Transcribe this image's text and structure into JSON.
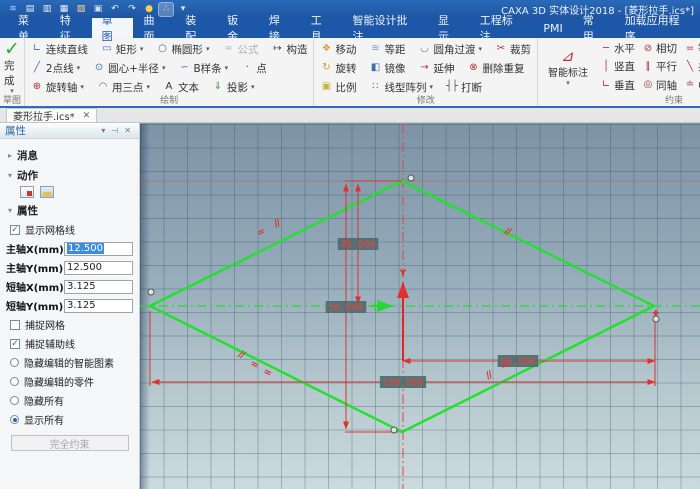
{
  "title_bar": {
    "title": "CAXA 3D 实体设计2018 - [菱形拉手.ics*]"
  },
  "qat": {
    "icons": [
      {
        "name": "app-logo",
        "glyph": "≋",
        "color": "#9fd4ff"
      },
      {
        "name": "new-file",
        "glyph": "▤",
        "color": "#eef3f9"
      },
      {
        "name": "open-file",
        "glyph": "▥",
        "color": "#eef3f9"
      },
      {
        "name": "import-file",
        "glyph": "▦",
        "color": "#eef3f9"
      },
      {
        "name": "open-folder",
        "glyph": "▧",
        "color": "#ffd98a"
      },
      {
        "name": "save",
        "glyph": "▣",
        "color": "#cfe0f2"
      },
      {
        "name": "undo",
        "glyph": "↶",
        "color": "#eef3f9"
      },
      {
        "name": "redo",
        "glyph": "↷",
        "color": "#eef3f9"
      },
      {
        "name": "options",
        "glyph": "●",
        "color": "#ffd24d"
      },
      {
        "name": "snap-settings",
        "glyph": "∴",
        "color": "#ffe28a",
        "active": true
      },
      {
        "name": "more",
        "glyph": "▾",
        "color": "#dbe6f2"
      }
    ]
  },
  "menu": {
    "items": [
      "菜单",
      "特征",
      "草图",
      "曲面",
      "装配",
      "钣金",
      "焊接",
      "工具",
      "智能设计批注",
      "显示",
      "工程标注",
      "PMI",
      "常用",
      "加载应用程序"
    ],
    "active": "草图"
  },
  "ribbon": {
    "sketch": {
      "finish_label": "完成",
      "label": "草图"
    },
    "draw": {
      "label": "绘制",
      "rows": [
        [
          {
            "n": "continuous-line",
            "g": "∟",
            "c": "#3a6fb5",
            "l": "连续直线"
          },
          {
            "n": "rectangle",
            "g": "▭",
            "c": "#3a6fb5",
            "l": "矩形",
            "cr": 1
          },
          {
            "n": "ellipse",
            "g": "○",
            "c": "#3a6fb5",
            "l": "椭圆形",
            "cr": 1
          },
          {
            "n": "formula",
            "g": "≈",
            "c": "#b8b8b8",
            "l": "公式",
            "dis": 1
          },
          {
            "n": "construction",
            "g": "↦",
            "c": "#444444",
            "l": "构造"
          }
        ],
        [
          {
            "n": "two-point-line",
            "g": "╱",
            "c": "#3a6fb5",
            "l": "2点线",
            "cr": 1
          },
          {
            "n": "circle-center-radius",
            "g": "⊙",
            "c": "#3a6fb5",
            "l": "圆心+半径",
            "cr": 1
          },
          {
            "n": "b-spline",
            "g": "∽",
            "c": "#3a6fb5",
            "l": "B样条",
            "cr": 1
          },
          {
            "n": "point",
            "g": "·",
            "c": "#333333",
            "l": "点"
          }
        ],
        [
          {
            "n": "rotation-axis",
            "g": "⊕",
            "c": "#b03030",
            "l": "旋转轴",
            "cr": 1
          },
          {
            "n": "three-point-arc",
            "g": "◠",
            "c": "#3a6fb5",
            "l": "用三点",
            "cr": 1
          },
          {
            "n": "text",
            "g": "A",
            "c": "#333333",
            "l": "文本"
          },
          {
            "n": "projection",
            "g": "⇓",
            "c": "#3a8f5a",
            "l": "投影",
            "cr": 1
          }
        ]
      ]
    },
    "modify": {
      "label": "修改",
      "rows": [
        [
          {
            "n": "move",
            "g": "❖",
            "c": "#e09a3a",
            "l": "移动"
          },
          {
            "n": "offset",
            "g": "≋",
            "c": "#7a9bd4",
            "l": "等距"
          },
          {
            "n": "fillet",
            "g": "◡",
            "c": "#3a6fb5",
            "l": "圆角过渡",
            "cr": 1
          },
          {
            "n": "trim",
            "g": "✂",
            "c": "#b03030",
            "l": "裁剪"
          }
        ],
        [
          {
            "n": "rotate",
            "g": "↻",
            "c": "#c59a3a",
            "l": "旋转"
          },
          {
            "n": "mirror",
            "g": "◧",
            "c": "#3a6fb5",
            "l": "镜像"
          },
          {
            "n": "extend",
            "g": "→",
            "c": "#b03030",
            "l": "延伸"
          },
          {
            "n": "delete-duplicate",
            "g": "⊗",
            "c": "#b03030",
            "l": "删除重复"
          }
        ],
        [
          {
            "n": "scale",
            "g": "▣",
            "c": "#c5b53a",
            "l": "比例"
          },
          {
            "n": "pattern",
            "g": "∷",
            "c": "#3a6fb5",
            "l": "线型阵列",
            "cr": 1
          },
          {
            "n": "break",
            "g": "┤├",
            "c": "#555555",
            "l": "打断"
          }
        ]
      ]
    },
    "constraint": {
      "label": "约束",
      "smart_dim": {
        "n": "smart-dimension",
        "label": "智能标注"
      },
      "rows": [
        [
          {
            "n": "horizontal-constraint",
            "g": "─",
            "c": "#b03030",
            "l": "水平"
          },
          {
            "n": "tangent-constraint",
            "g": "⊘",
            "c": "#b03030",
            "l": "相切"
          },
          {
            "n": "equal-length-constraint",
            "g": "=",
            "c": "#b03030",
            "l": "等长"
          },
          {
            "n": "coincident-constraint",
            "g": "∠",
            "c": "#b03030",
            "l": "重合",
            "act": 1
          },
          {
            "n": "pierce-constraint",
            "g": "▷",
            "c": "#b03030",
            "l": "穿透"
          }
        ],
        [
          {
            "n": "vertical-constraint",
            "g": "│",
            "c": "#b03030",
            "l": "竖直"
          },
          {
            "n": "parallel-constraint",
            "g": "∥",
            "c": "#b03030",
            "l": "平行"
          },
          {
            "n": "collinear-constraint",
            "g": "╲",
            "c": "#b03030",
            "l": "共线"
          },
          {
            "n": "mirror-constraint",
            "g": "◫",
            "c": "#b03030",
            "l": "镜像"
          },
          {
            "n": "edit-dimension",
            "g": "✎",
            "c": "#b03030",
            "l": "编辑尺寸"
          }
        ],
        [
          {
            "n": "perpendicular-constraint",
            "g": "∟",
            "c": "#b03030",
            "l": "垂直"
          },
          {
            "n": "concentric-constraint",
            "g": "◎",
            "c": "#b03030",
            "l": "同轴"
          },
          {
            "n": "midpoint-constraint",
            "g": "≐",
            "c": "#b03030",
            "l": "中点"
          },
          {
            "n": "fixed-constraint",
            "g": "⊥",
            "c": "#b03030",
            "l": "固定"
          },
          {
            "n": "horizontal-dim",
            "g": "◈",
            "c": "#b03030",
            "l": "水平",
            "cr": 1
          }
        ]
      ]
    }
  },
  "document_tab": {
    "label": "菱形拉手.ics*",
    "close": "✕"
  },
  "properties_panel": {
    "title": "属性",
    "header_icons": [
      "collapse-icon",
      "pin-icon",
      "close-icon"
    ],
    "sections": {
      "messages": "消息",
      "actions": "动作",
      "properties": "属性"
    },
    "action_icons": [
      "edit-action-icon",
      "save-action-icon"
    ],
    "show_grid": {
      "label": "显示网格线",
      "checked": true
    },
    "fields": [
      {
        "label": "主轴X(mm)",
        "value": "12.500",
        "selected": true
      },
      {
        "label": "主轴Y(mm)",
        "value": "12.500"
      },
      {
        "label": "短轴X(mm)",
        "value": "3.125"
      },
      {
        "label": "短轴Y(mm)",
        "value": "3.125"
      }
    ],
    "checkboxes": [
      {
        "label": "捕捉网格",
        "checked": false
      },
      {
        "label": "捕捉辅助线",
        "checked": true
      }
    ],
    "radios": [
      {
        "label": "隐藏编辑的智能图素",
        "selected": false
      },
      {
        "label": "隐藏编辑的零件",
        "selected": false
      },
      {
        "label": "隐藏所有",
        "selected": false
      },
      {
        "label": "显示所有",
        "selected": true
      }
    ],
    "button_label": "完全约束"
  },
  "canvas": {
    "shape_color": "#1fe32b",
    "dim_color": "#e03030",
    "centerline_green": "#2ad636",
    "centerline_red": "#e04545",
    "label_bg": "#4d6d72",
    "label_fg": "#ef4435",
    "diamond": [
      [
        262,
        57
      ],
      [
        514,
        182
      ],
      [
        262,
        308
      ],
      [
        10,
        182
      ]
    ],
    "center": {
      "x": 263,
      "y": 182
    },
    "aux_h_red_y": 57,
    "dims": [
      {
        "name": "half-height-dim",
        "value": "25.000",
        "x1": 218,
        "y1": 60,
        "x2": 218,
        "y2": 180,
        "lx": 218,
        "ly": 120
      },
      {
        "name": "full-height-dim",
        "value": "50.000",
        "x1": 206,
        "y1": 60,
        "x2": 206,
        "y2": 305,
        "lx": 206,
        "ly": 183
      },
      {
        "name": "half-width-dim",
        "value": "50.000",
        "x1": 263,
        "y1": 237,
        "x2": 515,
        "y2": 237,
        "lx": 378,
        "ly": 237
      },
      {
        "name": "full-width-dim",
        "value": "100.000",
        "x1": 12,
        "y1": 258,
        "x2": 515,
        "y2": 258,
        "lx": 263,
        "ly": 258
      }
    ],
    "ext_lines": [
      [
        205,
        57,
        262,
        57
      ],
      [
        205,
        308,
        258,
        308
      ],
      [
        515,
        187,
        515,
        262
      ],
      [
        10,
        187,
        10,
        262
      ]
    ],
    "marks": [
      {
        "t": "//",
        "x": 138,
        "y": 102,
        "r": -26
      },
      {
        "t": "=",
        "x": 122,
        "y": 111,
        "r": -26
      },
      {
        "t": "//",
        "x": 366,
        "y": 110,
        "r": 26
      },
      {
        "t": "//",
        "x": 100,
        "y": 233,
        "r": 26
      },
      {
        "t": "=",
        "x": 113,
        "y": 243,
        "r": 26
      },
      {
        "t": "=",
        "x": 126,
        "y": 251,
        "r": 26
      },
      {
        "t": "=",
        "x": 366,
        "y": 244,
        "r": -26
      },
      {
        "t": "//",
        "x": 350,
        "y": 254,
        "r": -26
      }
    ],
    "vertex_markers": [
      [
        271,
        54
      ],
      [
        11,
        168
      ],
      [
        254,
        306
      ],
      [
        516,
        195
      ]
    ],
    "coincident_cross": {
      "x": 516,
      "y": 189
    },
    "axis": {
      "y_label": "Y",
      "y_x": 263,
      "y_top": 159,
      "y_bottom": 237,
      "x_y": 182,
      "x_from": 231,
      "x_to": 252
    }
  }
}
